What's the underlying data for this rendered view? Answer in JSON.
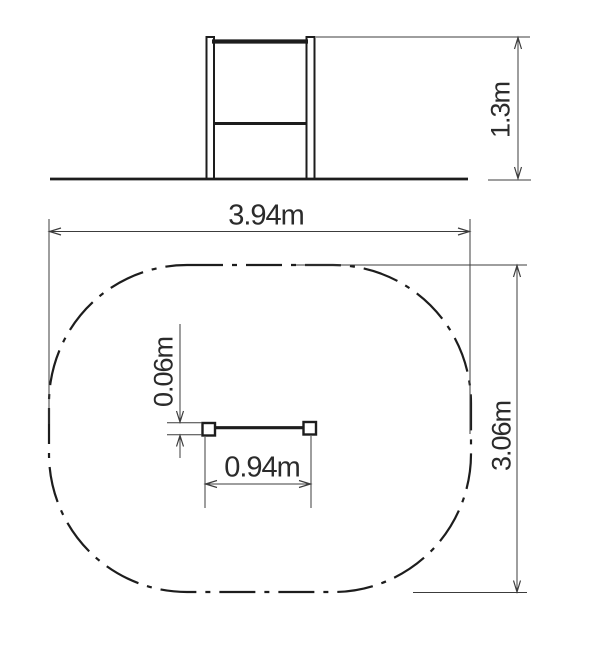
{
  "drawing": {
    "type": "playground-equipment-technical-drawing",
    "views": {
      "elevation": "side elevation of horizontal bar on ground line",
      "plan": "plan view with dash-dot impact safety zone outline"
    },
    "colors": {
      "background": "#ffffff",
      "object_line": "#1d1d1d",
      "dimension_line": "#3c3c3c",
      "text": "#2b2b2b"
    }
  },
  "labels": {
    "elevation_height": "1.3m",
    "zone_width": "3.94m",
    "zone_depth": "3.06m",
    "bar_length": "0.94m",
    "bar_offset": "0.06m"
  }
}
